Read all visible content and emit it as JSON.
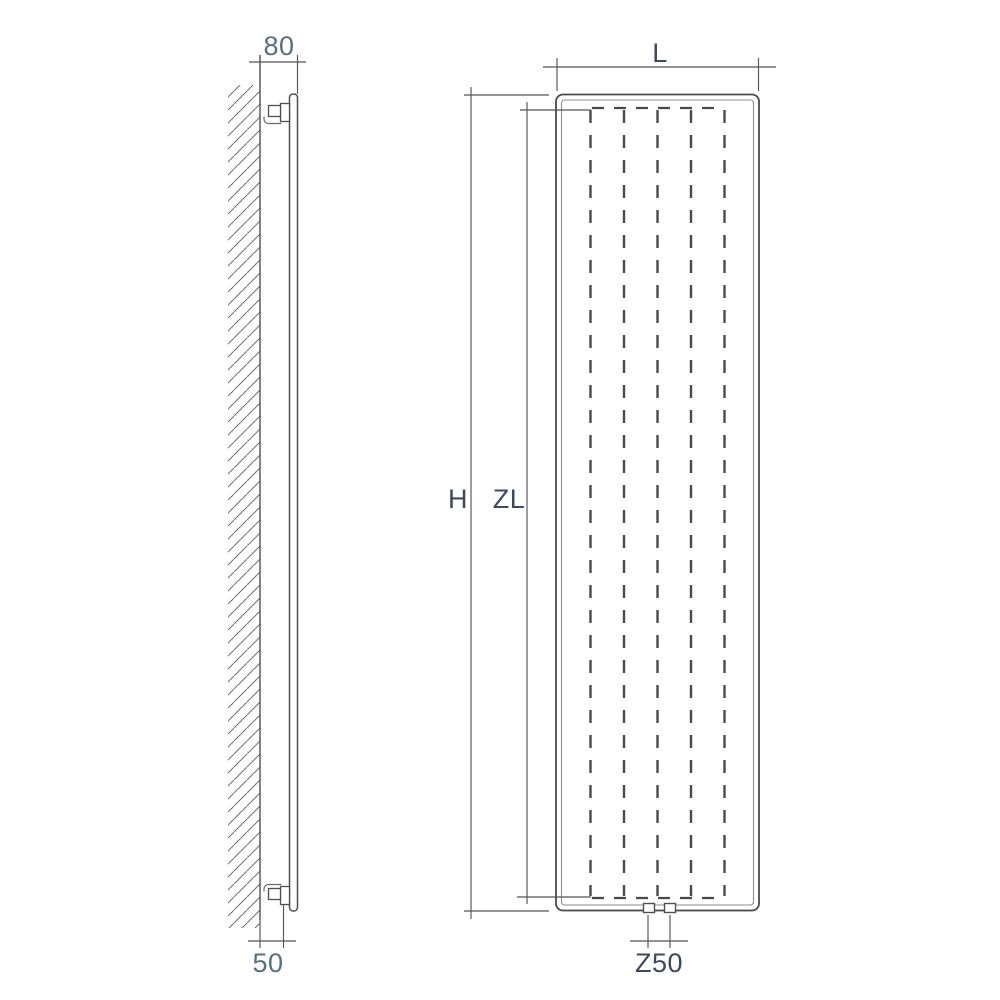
{
  "title": "Vertical radiator dimensional drawing",
  "colors": {
    "background": "#ffffff",
    "line_dark": "#4a4a4a",
    "line_medium": "#6b6b6b",
    "line_light": "#8d8d8d",
    "label_dark": "#3d4a5e",
    "label_muted": "#58707f"
  },
  "side_view": {
    "name": "side profile with wall mounting",
    "dimensions": [
      {
        "id": "depth-from-wall",
        "label": "80"
      },
      {
        "id": "bottom-bracket-offset",
        "label": "50"
      }
    ]
  },
  "front_view": {
    "name": "front elevation",
    "dimensions": [
      {
        "id": "width",
        "label": "L"
      },
      {
        "id": "overall-height",
        "label": "H"
      },
      {
        "id": "element-height",
        "label": "ZL"
      },
      {
        "id": "connection-centres",
        "label": "Z50"
      }
    ]
  }
}
